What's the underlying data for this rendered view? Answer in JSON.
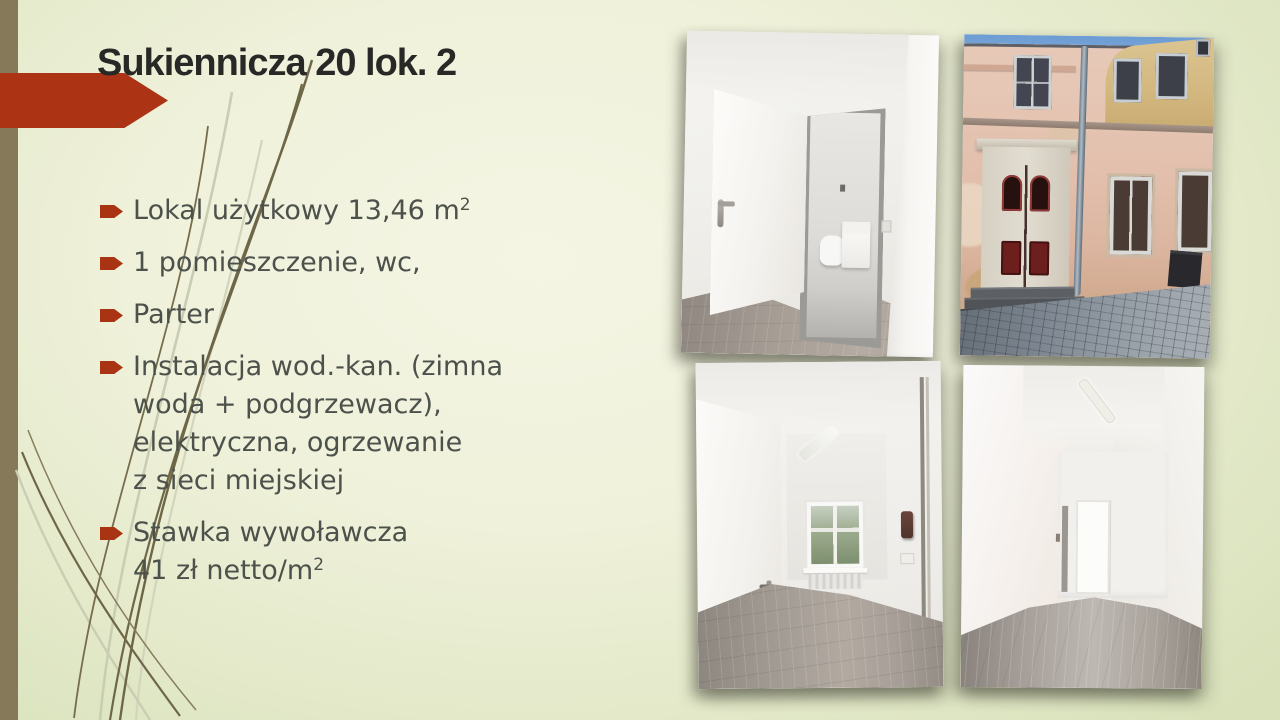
{
  "slide": {
    "title": "Sukiennicza 20 lok. 2",
    "bullets": [
      {
        "text": "Lokal użytkowy 13,46 m",
        "sup": "2"
      },
      {
        "text": "1 pomieszczenie, wc,",
        "sup": ""
      },
      {
        "text": "Parter",
        "sup": ""
      },
      {
        "text": "Instalacja wod.-kan. (zimna\nwoda + podgrzewacz),\nelektryczna, ogrzewanie\nz sieci miejskiej",
        "sup": ""
      },
      {
        "text": "Stawka wywoławcza\n41 zł netto/m",
        "sup": "2"
      }
    ],
    "photos": [
      {
        "label": "interior-open-door-wc"
      },
      {
        "label": "tenement-facade-red-door"
      },
      {
        "label": "room-with-window"
      },
      {
        "label": "empty-room-gray-floor"
      }
    ],
    "colors": {
      "accent_red": "#ac3415",
      "left_bar": "#86795a",
      "grass_dark": "#6e6747",
      "grass_light": "#c9cdb2",
      "bg_center": "#f5f5e4",
      "bg_edge": "#d8e1ba",
      "title_text": "#282826",
      "body_text": "#4c514b"
    }
  }
}
